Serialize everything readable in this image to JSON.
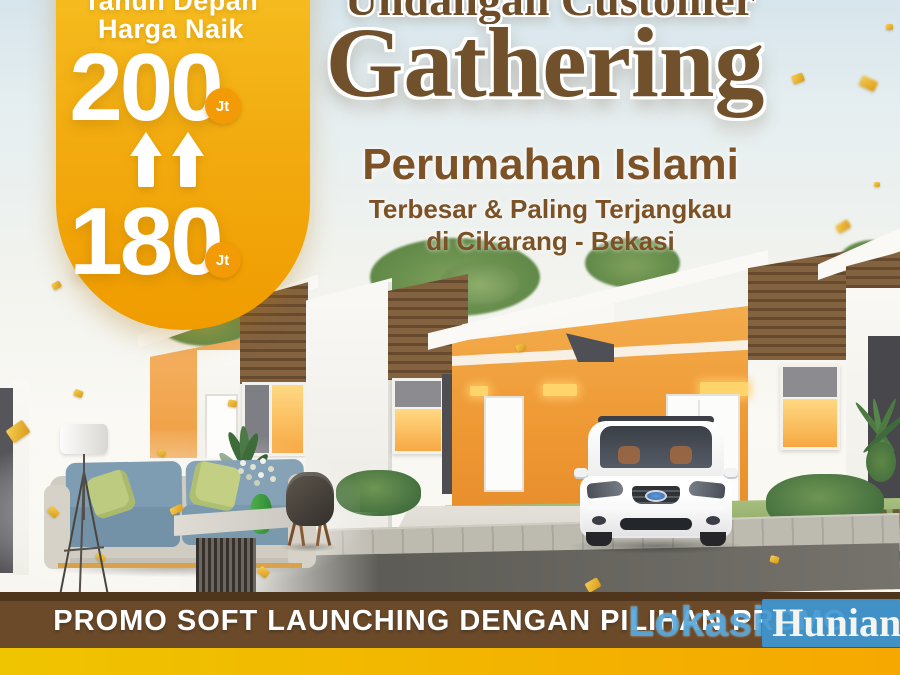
{
  "poster": {
    "price_bubble": {
      "top_line": "Tahun Depan",
      "second_line": "Harga Naik",
      "future_price": "200",
      "current_price": "180",
      "unit_label": "Jt",
      "colors": {
        "bubble_top": "#F7C225",
        "bubble_bottom": "#F09C00",
        "unit_badge": "#F29B06",
        "text": "#FFFFFF"
      }
    },
    "headline": {
      "line1": "Undangan Customer",
      "line2": "Gathering",
      "color": "#70512C"
    },
    "subheadline": {
      "title": "Perumahan Islami",
      "tagline_line1": "Terbesar & Paling Terjangkau",
      "tagline_line2": "di Cikarang - Bekasi",
      "color": "#7C5226"
    },
    "promo_banner": {
      "text": "PROMO SOFT LAUNCHING DENGAN PILIHAN PROMO",
      "bg_color": "#6B4A2A",
      "text_color": "#FFFFFF"
    },
    "bottom_strip": {
      "gradient_left": "#EFC400",
      "gradient_right": "#F6A800"
    },
    "watermark": {
      "word1": "Lokasi",
      "word2": "Hunian",
      "word1_color": "#4DA4DC",
      "word2_bg": "#3E97D2",
      "word2_color": "#FFFFFF"
    },
    "scene": {
      "house_wall_accent": "#EFA13E",
      "wood_siding": "#7C5C3E",
      "window_glow": "#FFC866",
      "sofa_color": "#7E9DB2",
      "pillow_color": "#BCCB7F",
      "road_color": "#6A6862",
      "grass_color": "#96B373",
      "confetti_color": "#E8B32A"
    }
  }
}
